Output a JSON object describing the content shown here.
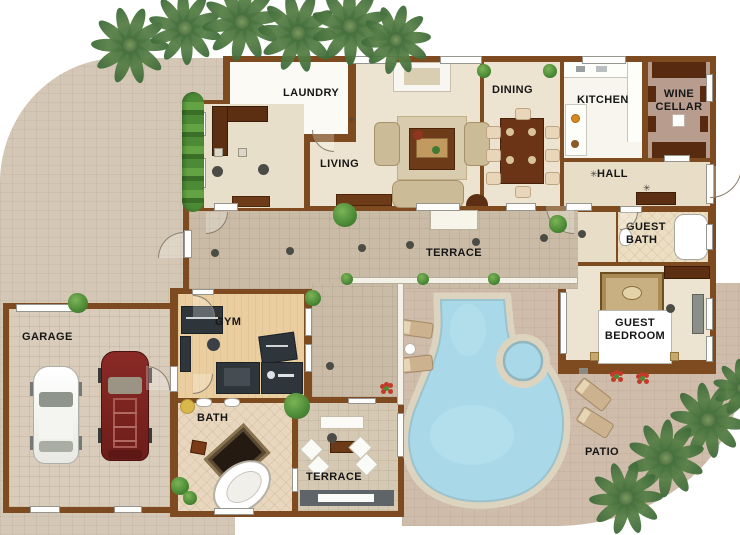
{
  "title": "Villa floor plan with pool",
  "rooms": {
    "laundry": "LAUNDRY",
    "living": "LIVING",
    "dining": "DINING",
    "kitchen": "KITCHEN",
    "wine_cellar": "WINE CELLAR",
    "hall": "HALL",
    "guest_bath": "GUEST BATH",
    "guest_bedroom": "GUEST BEDROOM",
    "terrace": "TERRACE",
    "gym": "GYM",
    "garage": "GARAGE",
    "bath": "BATH",
    "terrace_south": "TERRACE",
    "patio": "PATIO"
  },
  "colors": {
    "wall": "#7d4b1f",
    "driveway": "#d4c7b5",
    "patio": "#cfbcab",
    "terrace_floor": "#c9bba6",
    "interior_floor": "#ece4d1",
    "pool_water": "#a9d9e9",
    "pool_deck": "#dcd4bf",
    "palm_green": "#4d7c49",
    "hedge_green": "#55a23b",
    "car_white": "#f2f2ef",
    "car_red": "#7a2421"
  }
}
